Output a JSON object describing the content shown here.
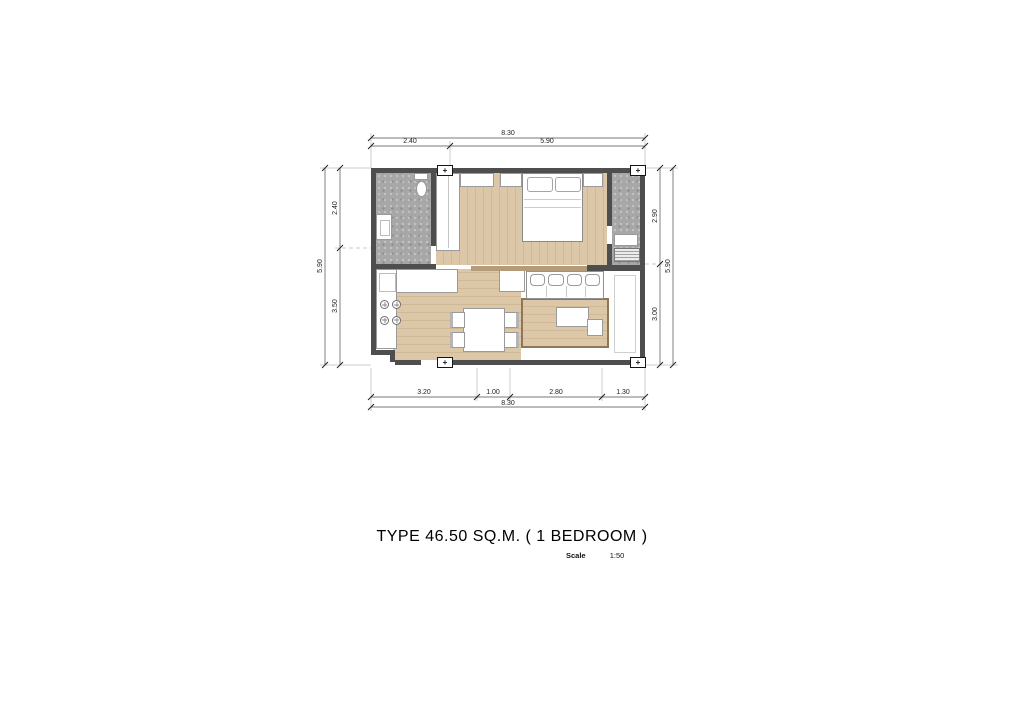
{
  "title": "TYPE 46.50 SQ.M. ( 1 BEDROOM )",
  "scale_label": "Scale",
  "scale_value": "1:50",
  "column_marker_symbol": "+",
  "dimensions": {
    "top": {
      "total": "8.30",
      "segments": [
        "2.40",
        "5.90"
      ]
    },
    "bottom": {
      "total": "8.30",
      "segments": [
        "3.20",
        "1.00",
        "2.80",
        "1.30"
      ]
    },
    "left": {
      "total": "5.90",
      "segments": [
        "2.40",
        "3.50"
      ]
    },
    "right": {
      "total": "5.90",
      "segments": [
        "2.90",
        "3.00"
      ]
    }
  },
  "colors": {
    "wall": "#4e4e4e",
    "wood": "#dcc8a8",
    "wood_line": "#d0ba95",
    "tile": "#a7a7a7",
    "dim_line": "#4d4d4d",
    "rug_border": "#8f7656"
  }
}
